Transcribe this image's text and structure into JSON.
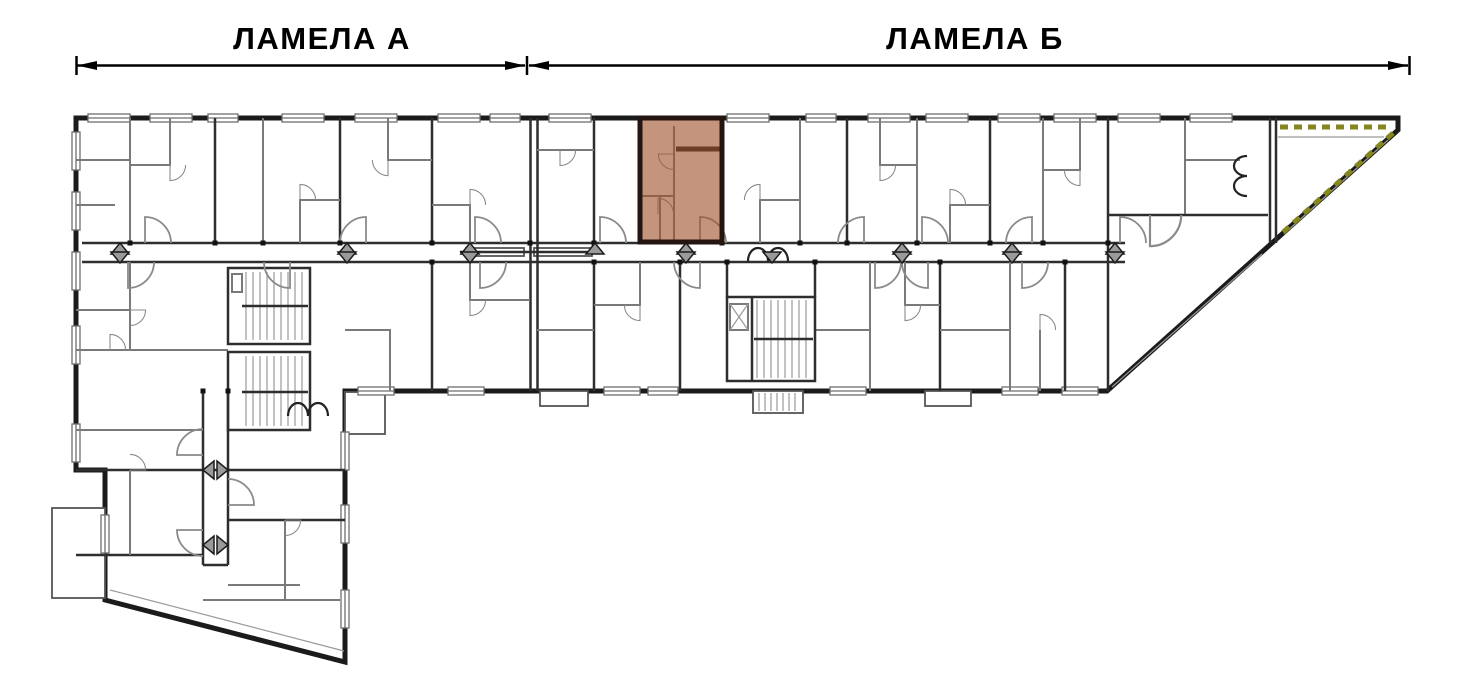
{
  "header": {
    "sections": [
      {
        "id": "lamela-a",
        "label": "ЛАМЕЛА А"
      },
      {
        "id": "lamela-b",
        "label": "ЛАМЕЛА  Б"
      }
    ]
  },
  "floor_plan": {
    "type": "apartment-building-floor-plan",
    "highlighted_unit": {
      "wing": "ЛАМЕЛА Б",
      "fill": "#A0522D",
      "fill_opacity": "0.62",
      "border_color": "#241510"
    },
    "colors": {
      "background": "#FFFFFF",
      "wall_dark": "#1B1B1B",
      "wall_mid": "#2E2E2E",
      "wall_light": "#7A7A7A",
      "door_arc": "#8A8A8A",
      "marker_fill": "#9A9A9A",
      "terrace_dash": "#86861E",
      "dimension": "#000000"
    }
  }
}
